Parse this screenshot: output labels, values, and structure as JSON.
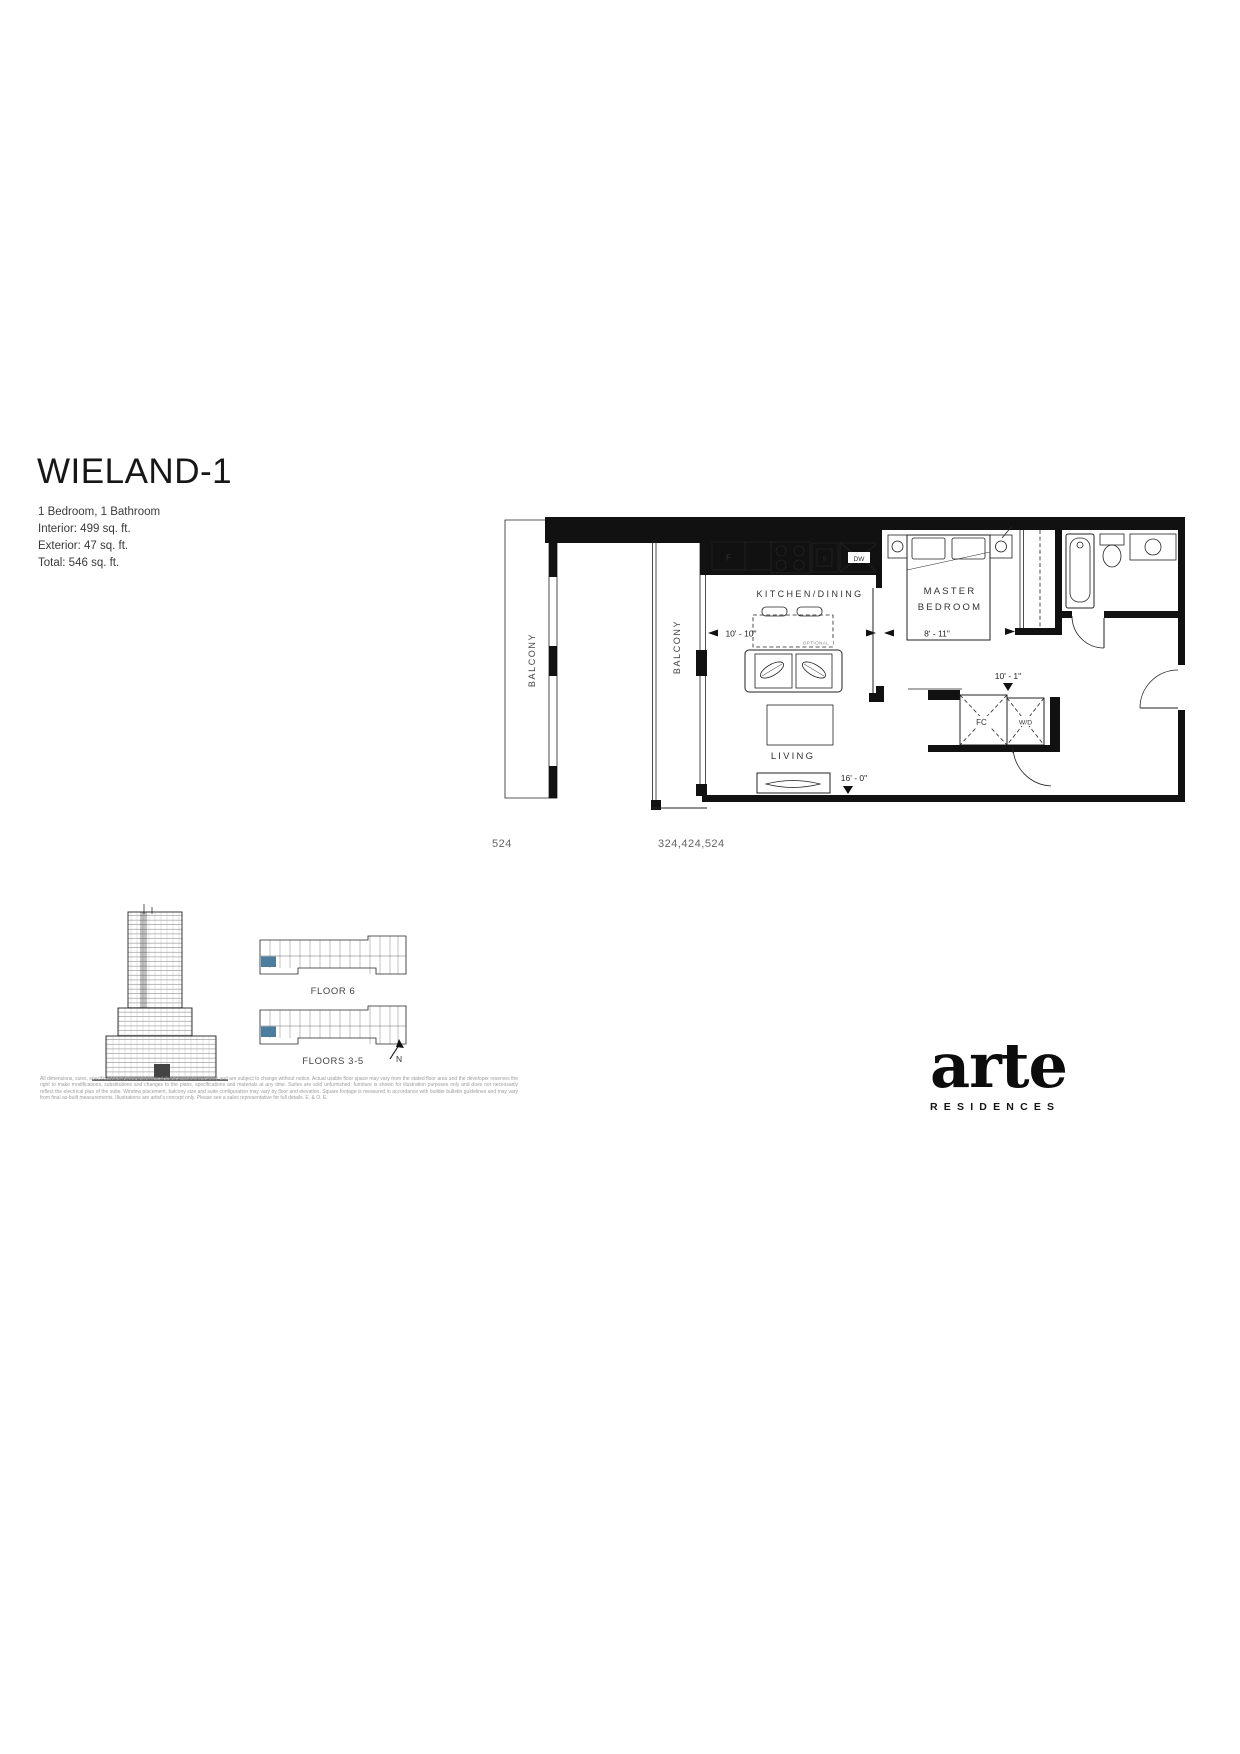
{
  "title": "WIELAND-1",
  "details": [
    "1 Bedroom, 1 Bathroom",
    "Interior: 499 sq. ft.",
    "Exterior: 47 sq. ft.",
    "Total: 546 sq. ft."
  ],
  "plan": {
    "balcony_label": "BALCONY",
    "kitchen_label": "KITCHEN/DINING",
    "optional_label": "OPTIONAL",
    "living_label": "LIVING",
    "master_line1": "MASTER",
    "master_line2": "BEDROOM",
    "appliances": {
      "fridge": "F",
      "sink": "S",
      "dishwasher": "DW"
    },
    "closets": {
      "front": "FC",
      "laundry": "W/D"
    },
    "dims": {
      "kitchen": "10' - 10\"",
      "bedroom": "8' - 11\"",
      "hall": "10' - 1\"",
      "living": "16' - 0\""
    },
    "unit_left": "524",
    "unit_right": "324,424,524"
  },
  "keyplans": {
    "floor6": "FLOOR 6",
    "floors35": "FLOORS 3-5",
    "north": "N",
    "highlight_color": "#4d7d9e"
  },
  "footer": {
    "disclaimer": "All dimensions, sizes, specifications, layouts and materials are approximate only and are subject to change without notice. Actual usable floor space may vary from the stated floor area and the developer reserves the right to make modifications, substitutions and changes to the plans, specifications and materials at any time. Suites are sold unfurnished; furniture is shown for illustration purposes only and does not necessarily reflect the electrical plan of the suite. Window placement, balcony size and suite configuration may vary by floor and elevation. Square footage is measured in accordance with builder bulletin guidelines and may vary from final as-built measurements. Illustrations are artist's concept only. Please see a sales representative for full details. E. & O. E."
  },
  "logo": {
    "name": "arte",
    "subtitle": "RESIDENCES"
  }
}
